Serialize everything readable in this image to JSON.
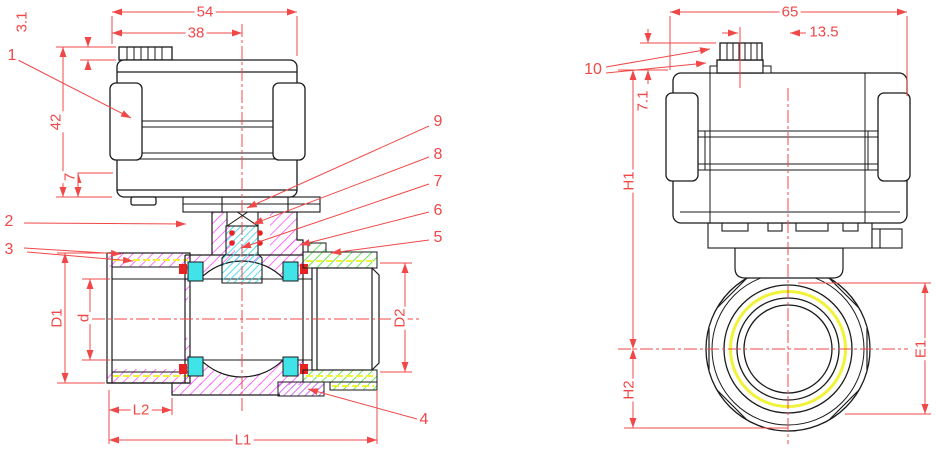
{
  "drawing_type": "CAD engineering drawing - motorized ball valve, sectioned front view and end view",
  "colors": {
    "dimension_red": "#f04848",
    "outline_black": "#1a1a1a",
    "body_section_magenta": "#ff44ff",
    "stem_seat_cyan": "#3fe3e8",
    "adapter_section_green": "#3ddd2d",
    "thread_yellow": "#f2f238",
    "adapter_section_purple": "#bb44ee",
    "seal_red": "#e82222"
  },
  "front_view": {
    "dimensions": {
      "actuator_width": "54",
      "connector_center_width": "38",
      "connector_cap_height": "3.1",
      "actuator_height": "42",
      "actuator_base_step": "7",
      "port_outer_diameter": "D1",
      "bore_diameter": "d",
      "thread_length": "L2",
      "overall_length": "L1",
      "right_port_diameter": "D2"
    },
    "callouts": {
      "c1": "1",
      "c2": "2",
      "c3": "3",
      "c4": "4",
      "c5": "5",
      "c6": "6",
      "c7": "7",
      "c8": "8",
      "c9": "9"
    }
  },
  "side_view": {
    "dimensions": {
      "actuator_depth": "65",
      "connector_offset_from_center": "13.5",
      "connector_height": "7.1",
      "height_above_centerline": "H1",
      "height_below_centerline": "H2",
      "end_across_flats": "E1"
    },
    "callouts": {
      "c10": "10"
    }
  }
}
